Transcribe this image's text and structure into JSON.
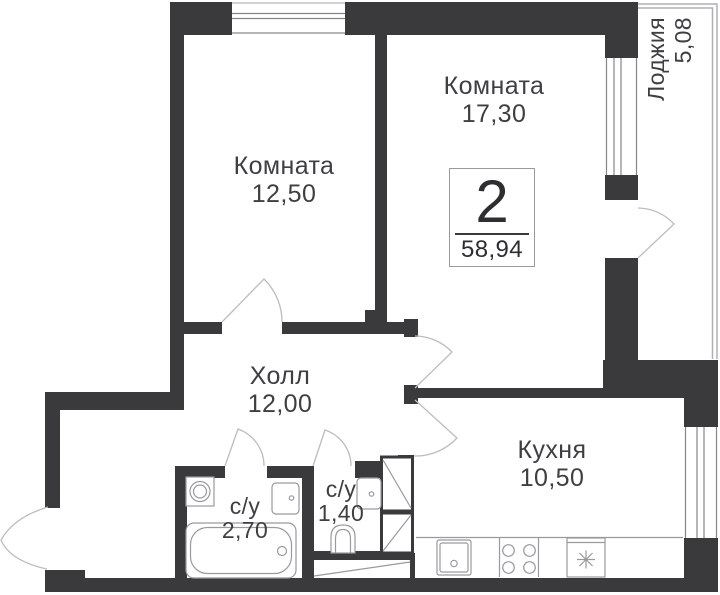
{
  "plan": {
    "badge": {
      "rooms_count": "2",
      "total_area": "58,94"
    },
    "rooms": [
      {
        "key": "room-a",
        "label": "Комната",
        "area": "12,50"
      },
      {
        "key": "room-b",
        "label": "Комната",
        "area": "17,30"
      },
      {
        "key": "loggia",
        "label": "Лоджия",
        "area": "5,08"
      },
      {
        "key": "hall",
        "label": "Холл",
        "area": "12,00"
      },
      {
        "key": "kitchen",
        "label": "Кухня",
        "area": "10,50"
      },
      {
        "key": "bath-main",
        "label": "с/у",
        "area": "2,70"
      },
      {
        "key": "bath-small",
        "label": "с/у",
        "area": "1,40"
      }
    ],
    "colors": {
      "wall": "#3a3a3c",
      "text": "#3f3f42",
      "fixture_line": "#9a9a9d",
      "door_line": "#bdbdbf",
      "glass_line": "#86868a",
      "balcony_line": "#b0b0b3",
      "bg": "#ffffff"
    }
  }
}
